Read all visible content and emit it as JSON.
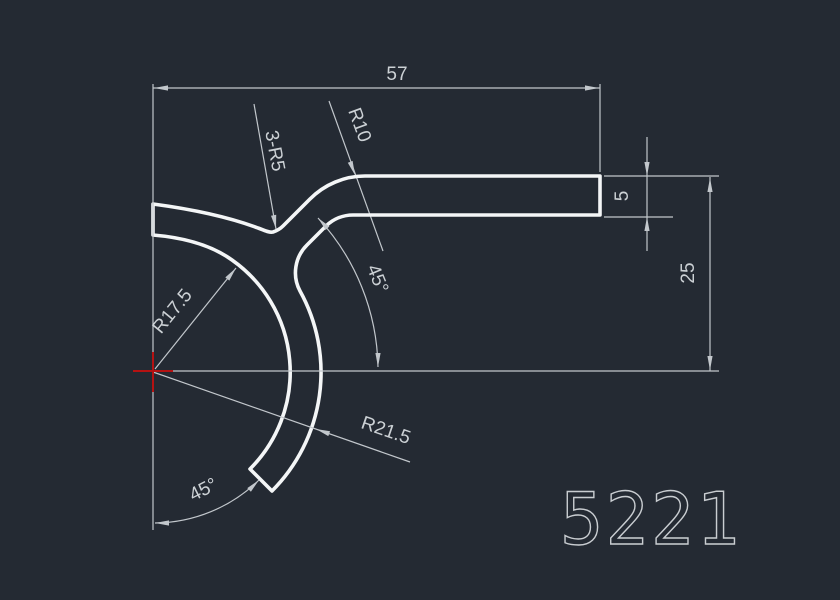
{
  "drawing": {
    "part_number": "5221",
    "dimensions": {
      "overall_width": "57",
      "bar_thickness": "5",
      "height_to_centerline": "25",
      "fillet_note": "3-R5",
      "corner_radius": "R10",
      "inner_hook_radius": "R17.5",
      "outer_hook_radius": "R21.5",
      "web_angle": "45°",
      "end_cut_angle": "45°"
    },
    "colors": {
      "background": "#242a33",
      "profile_line": "#f4f6f7",
      "dimension_line": "#c2c7cc",
      "dimension_text": "#ccd1d5",
      "crosshair": "#b51212",
      "part_number": "#c9cdd1"
    }
  }
}
